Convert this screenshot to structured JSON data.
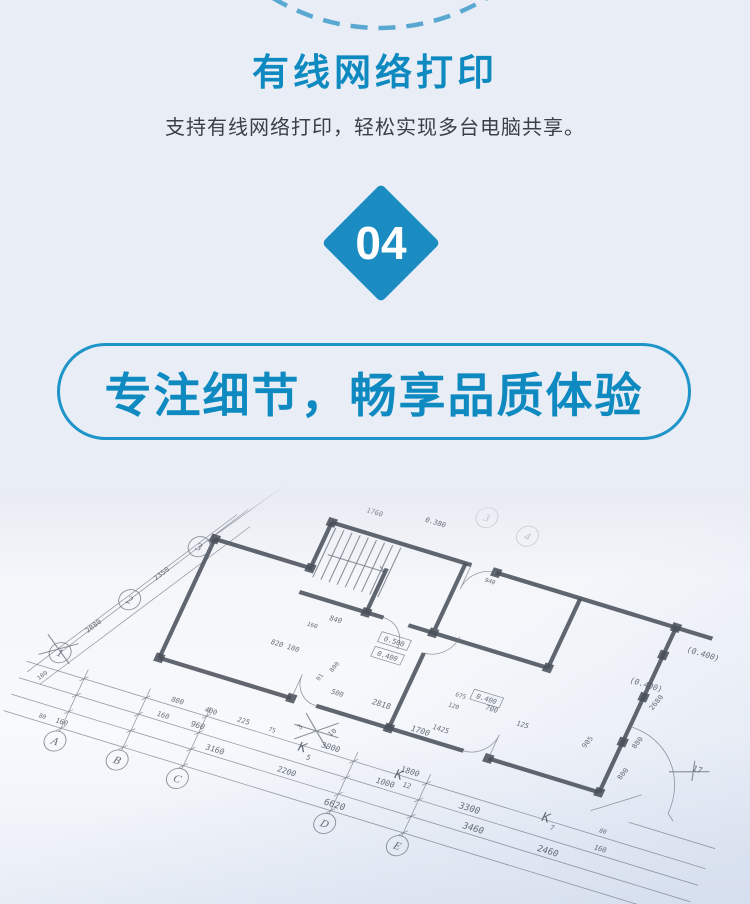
{
  "theme": {
    "page-bg": "#e9edf5",
    "brand-blue": "#0e8ac1",
    "diamond-blue": "#1b8cc2",
    "arc-blue": "#58a8d2",
    "pill-border": "#1e94c8",
    "subtitle-color": "#3c3f45",
    "bullet-blue": "#1a8fc6"
  },
  "header": {
    "title": "有线网络打印",
    "subtitle": "支持有线网络打印，轻松实现多台电脑共享。"
  },
  "step_badge": {
    "number": "04"
  },
  "banner": {
    "text": "专注细节，畅享品质体验"
  },
  "features": {
    "items": [
      {
        "label": "工程图纸"
      },
      {
        "label": "设计图纸"
      }
    ]
  },
  "blueprint": {
    "grid_bubbles": [
      {
        "t": "A",
        "x": 0,
        "y": 0
      },
      {
        "t": "B",
        "x": 65,
        "y": 0
      },
      {
        "t": "C",
        "x": 128,
        "y": 0
      },
      {
        "t": "D",
        "x": 282,
        "y": 0
      },
      {
        "t": "E",
        "x": 358,
        "y": 0
      },
      {
        "t": "1",
        "x": -33,
        "y": -86
      },
      {
        "t": "2",
        "x": 8,
        "y": -157
      },
      {
        "t": "3",
        "x": 49,
        "y": -228
      },
      {
        "t": "3",
        "x": 300,
        "y": -340,
        "f": true
      },
      {
        "t": "4",
        "x": 345,
        "y": -334,
        "f": true
      }
    ],
    "labels": [
      {
        "t": "80",
        "x": -22,
        "y": -18,
        "s": 6
      },
      {
        "t": "160",
        "x": -2,
        "y": -18,
        "s": 7
      },
      {
        "t": "6620",
        "x": 283,
        "y": -18,
        "s": 9
      },
      {
        "t": "3160",
        "x": 150,
        "y": -36,
        "s": 8
      },
      {
        "t": "2200",
        "x": 225,
        "y": -36,
        "s": 8
      },
      {
        "t": "3460",
        "x": 420,
        "y": -36,
        "s": 9
      },
      {
        "t": "2460",
        "x": 498,
        "y": -36,
        "s": 9
      },
      {
        "t": "160",
        "x": 88,
        "y": -54,
        "s": 7
      },
      {
        "t": "960",
        "x": 124,
        "y": -54,
        "s": 8
      },
      {
        "t": "1000",
        "x": 320,
        "y": -54,
        "s": 8
      },
      {
        "t": "3300",
        "x": 408,
        "y": -54,
        "s": 9
      },
      {
        "t": "160",
        "x": 545,
        "y": -54,
        "s": 7
      },
      {
        "t": "800",
        "x": 95,
        "y": -72,
        "s": 7
      },
      {
        "t": "400",
        "x": 130,
        "y": -72,
        "s": 7
      },
      {
        "t": "225",
        "x": 164,
        "y": -72,
        "s": 7
      },
      {
        "t": "75",
        "x": 194,
        "y": -72,
        "s": 6
      },
      {
        "t": "3000",
        "x": 255,
        "y": -72,
        "s": 8
      },
      {
        "t": "1800",
        "x": 338,
        "y": -72,
        "s": 8
      },
      {
        "t": "80",
        "x": 540,
        "y": -72,
        "s": 6
      },
      {
        "t": "2880",
        "x": -12,
        "y": -120,
        "s": 7,
        "r": -60
      },
      {
        "t": "2350",
        "x": 28,
        "y": -190,
        "s": 7,
        "r": -60
      },
      {
        "t": "180",
        "x": -38,
        "y": -58,
        "s": 6,
        "r": -60
      },
      {
        "t": "K",
        "x": 229,
        "y": -62,
        "s": 13
      },
      {
        "t": "5",
        "x": 239,
        "y": -56,
        "s": 7
      },
      {
        "t": "K",
        "x": 329,
        "y": -64,
        "s": 13
      },
      {
        "t": "12",
        "x": 341,
        "y": -58,
        "s": 7
      },
      {
        "t": "K",
        "x": 482,
        "y": -66,
        "s": 13
      },
      {
        "t": "7",
        "x": 492,
        "y": -60,
        "s": 7
      },
      {
        "t": "500",
        "x": 238,
        "y": -126,
        "s": 7
      },
      {
        "t": "2818",
        "x": 283,
        "y": -128,
        "s": 8
      },
      {
        "t": "1700",
        "x": 330,
        "y": -114,
        "s": 8
      },
      {
        "t": "91",
        "x": 217,
        "y": -138,
        "s": 6,
        "r": -75
      },
      {
        "t": "800",
        "x": 226,
        "y": -152,
        "s": 6,
        "r": -75
      },
      {
        "t": "820 100",
        "x": 170,
        "y": -156,
        "s": 7
      },
      {
        "t": "1425",
        "x": 348,
        "y": -122,
        "s": 7
      },
      {
        "t": "120",
        "x": 350,
        "y": -148,
        "s": 6
      },
      {
        "t": "675",
        "x": 352,
        "y": -160,
        "s": 6
      },
      {
        "t": "700",
        "x": 386,
        "y": -156,
        "s": 7
      },
      {
        "t": "125",
        "x": 421,
        "y": -150,
        "s": 7
      },
      {
        "t": "905",
        "x": 490,
        "y": -154,
        "s": 7,
        "r": -75
      },
      {
        "t": "840",
        "x": 205,
        "y": -196,
        "s": 7
      },
      {
        "t": "160",
        "x": 186,
        "y": -184,
        "s": 6
      },
      {
        "t": "800",
        "x": 536,
        "y": -134,
        "s": 7,
        "r": -75
      },
      {
        "t": "880",
        "x": 536,
        "y": -168,
        "s": 7,
        "r": -75
      },
      {
        "t": "2680",
        "x": 536,
        "y": -212,
        "s": 7,
        "r": -75
      },
      {
        "t": "0.500",
        "x": 268,
        "y": -192,
        "s": 7,
        "box": true
      },
      {
        "t": "0.400",
        "x": 268,
        "y": -176,
        "s": 7,
        "box": true
      },
      {
        "t": "0.400",
        "x": 377,
        "y": -164,
        "s": 7,
        "box": true
      },
      {
        "t": "(0.400)",
        "x": 517,
        "y": -224,
        "s": 8
      },
      {
        "t": "(0.400)",
        "x": 556,
        "y": -270,
        "s": 8
      },
      {
        "t": "0.380",
        "x": 255,
        "y": -318,
        "s": 7
      },
      {
        "t": "1760",
        "x": 195,
        "y": -310,
        "s": 7
      },
      {
        "t": "940",
        "x": 330,
        "y": -278,
        "s": 6
      },
      {
        "t": "17",
        "x": 600,
        "y": -158,
        "s": 8
      },
      {
        "t": "10",
        "x": 252,
        "y": -88,
        "s": 7,
        "r": -60
      },
      {
        "t": "3",
        "x": 220,
        "y": -84,
        "s": 7,
        "r": -60
      }
    ]
  }
}
